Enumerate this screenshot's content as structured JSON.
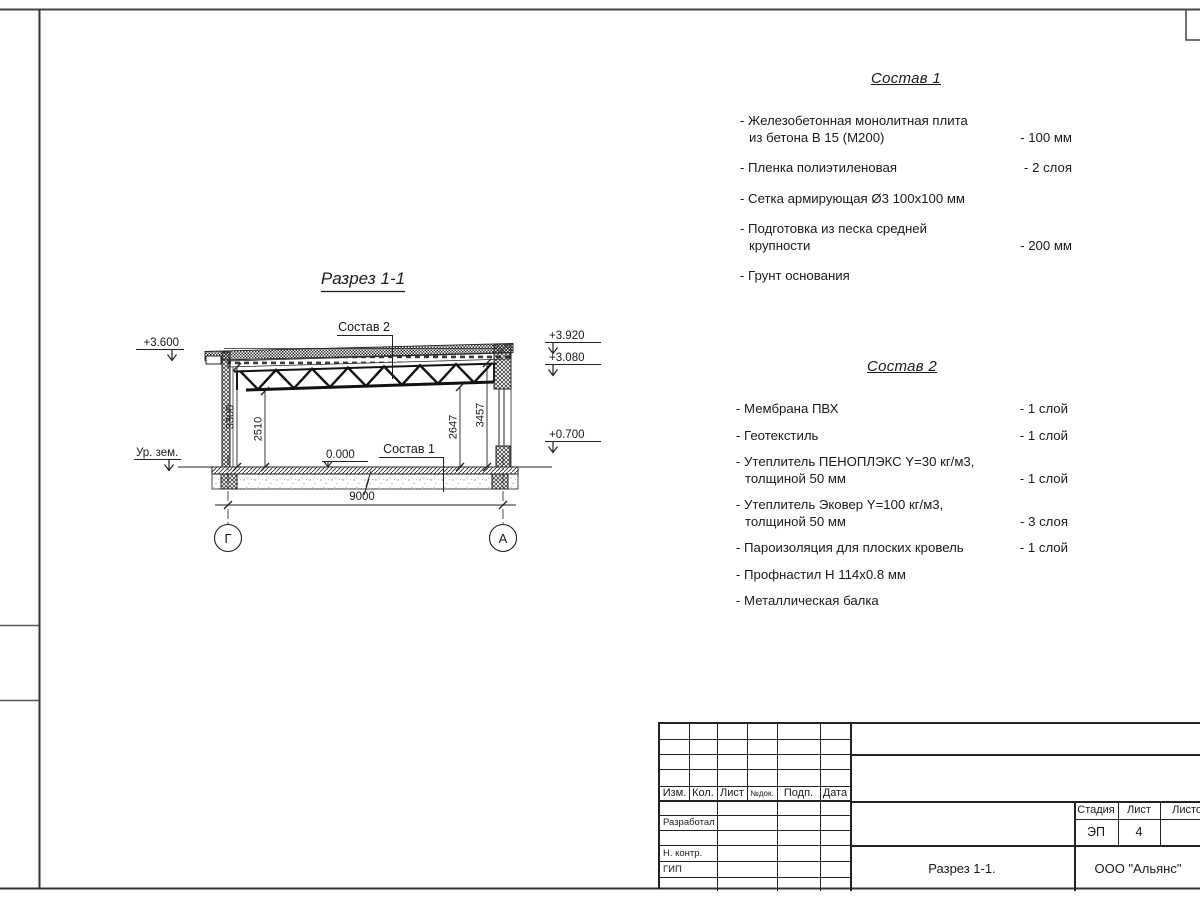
{
  "drawing": {
    "section_title": "Разрез 1-1",
    "labels": {
      "sostav1_ref": "Состав 1",
      "sostav2_ref": "Состав 2",
      "ground_level": "Ур. зем.",
      "zero_level": "0.000"
    },
    "elevations": {
      "left_top": "+3.600",
      "right_top": "+3.920",
      "right_mid": "+3.080",
      "right_low": "+0.700"
    },
    "dimensions": {
      "left_inner": "3300",
      "left_clear": "2510",
      "right_clear": "2647",
      "right_inner": "3457",
      "span": "9000"
    },
    "axes": {
      "left": "Г",
      "right": "А"
    }
  },
  "sostav1": {
    "title": "Состав 1",
    "items": [
      {
        "line1": "- Железобетонная  монолитная плита",
        "line2": "из бетона В 15 (М200)",
        "value": "- 100 мм"
      },
      {
        "line1": "- Пленка полиэтиленовая",
        "line2": "",
        "value": "- 2 слоя"
      },
      {
        "line1": "- Сетка армирующая Ø3 100х100 мм",
        "line2": "",
        "value": ""
      },
      {
        "line1": "- Подготовка из песка средней",
        "line2": "крупности",
        "value": "- 200 мм"
      },
      {
        "line1": "- Грунт основания",
        "line2": "",
        "value": ""
      }
    ]
  },
  "sostav2": {
    "title": "Состав 2",
    "items": [
      {
        "line1": "- Мембрана ПВХ",
        "line2": "",
        "value": "- 1 слой"
      },
      {
        "line1": "- Геотекстиль",
        "line2": "",
        "value": "- 1 слой"
      },
      {
        "line1": "- Утеплитель ПЕНОПЛЭКС Y=30 кг/м3,",
        "line2": "толщиной 50 мм",
        "value": "- 1 слой"
      },
      {
        "line1": "- Утеплитель Эковер Y=100 кг/м3,",
        "line2": "толщиной 50 мм",
        "value": "- 3 слоя"
      },
      {
        "line1": "- Пароизоляция для плоских кровель",
        "line2": "",
        "value": "- 1 слой"
      },
      {
        "line1": "- Профнастил Н 114х0.8 мм",
        "line2": "",
        "value": ""
      },
      {
        "line1": "- Металлическая балка",
        "line2": "",
        "value": ""
      }
    ]
  },
  "titleblock": {
    "columns": [
      "Изм.",
      "Кол.",
      "Лист",
      "№док.",
      "Подп.",
      "Дата"
    ],
    "row_developed": "Разработал",
    "row_ncontrol": "Н. контр.",
    "row_gip": "ГИП",
    "stage_label": "Стадия",
    "sheet_label": "Лист",
    "sheets_label": "Листов",
    "stage_value": "ЭП",
    "sheet_value": "4",
    "doc_title": "Разрез 1-1.",
    "company": "ООО \"Альянс\""
  }
}
